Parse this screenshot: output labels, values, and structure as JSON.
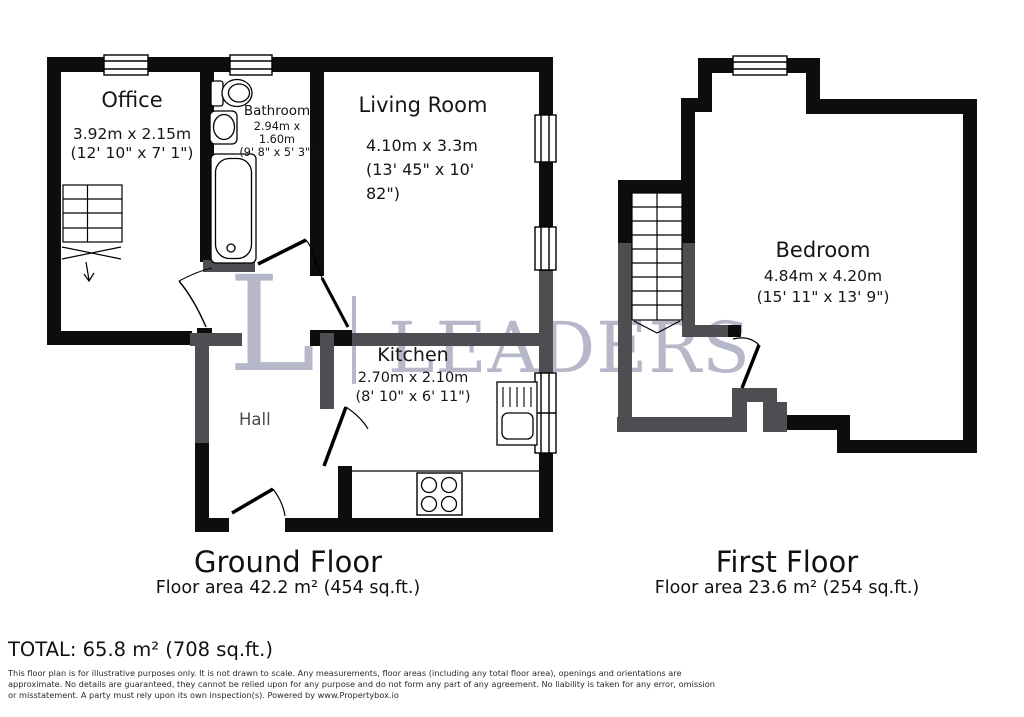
{
  "watermark": {
    "initial": "L",
    "word": "LEADERS"
  },
  "ground_floor": {
    "title": "Ground Floor",
    "area": "Floor area 42.2 m² (454 sq.ft.)",
    "rooms": {
      "office": {
        "name": "Office",
        "metric": "3.92m x 2.15m",
        "imperial": "(12' 10\" x 7' 1\")"
      },
      "bathroom": {
        "name": "Bathroom",
        "metric": "2.94m x 1.60m",
        "imperial": "(9' 8\" x 5' 3\")"
      },
      "living_room": {
        "name": "Living Room",
        "metric": "4.10m x 3.3m",
        "imperial_lines": [
          "(13' 45\" x 10'",
          "82\")"
        ]
      },
      "kitchen": {
        "name": "Kitchen",
        "metric": "2.70m x 2.10m",
        "imperial": "(8' 10\" x 6' 11\")"
      },
      "hall": {
        "name": "Hall"
      }
    }
  },
  "first_floor": {
    "title": "First Floor",
    "area": "Floor area 23.6 m² (254 sq.ft.)",
    "rooms": {
      "bedroom": {
        "name": "Bedroom",
        "metric": "4.84m x 4.20m",
        "imperial": "(15' 11\" x 13' 9\")"
      }
    }
  },
  "total": "TOTAL: 65.8 m² (708 sq.ft.)",
  "disclaimer": "This floor plan is for illustrative purposes only. It is not drawn to scale. Any measurements, floor areas (including any total floor area), openings and orientations are approximate. No details are guaranteed, they cannot be relied upon for any purpose and do not form any part of any agreement. No liability is taken for any error, omission or misstatement. A party must rely upon its own inspection(s). Powered by www.Propertybox.io",
  "colors": {
    "wall": "#0d0d0d",
    "wall_secondary": "#4e4e52",
    "watermark": "#b6b7c8"
  }
}
